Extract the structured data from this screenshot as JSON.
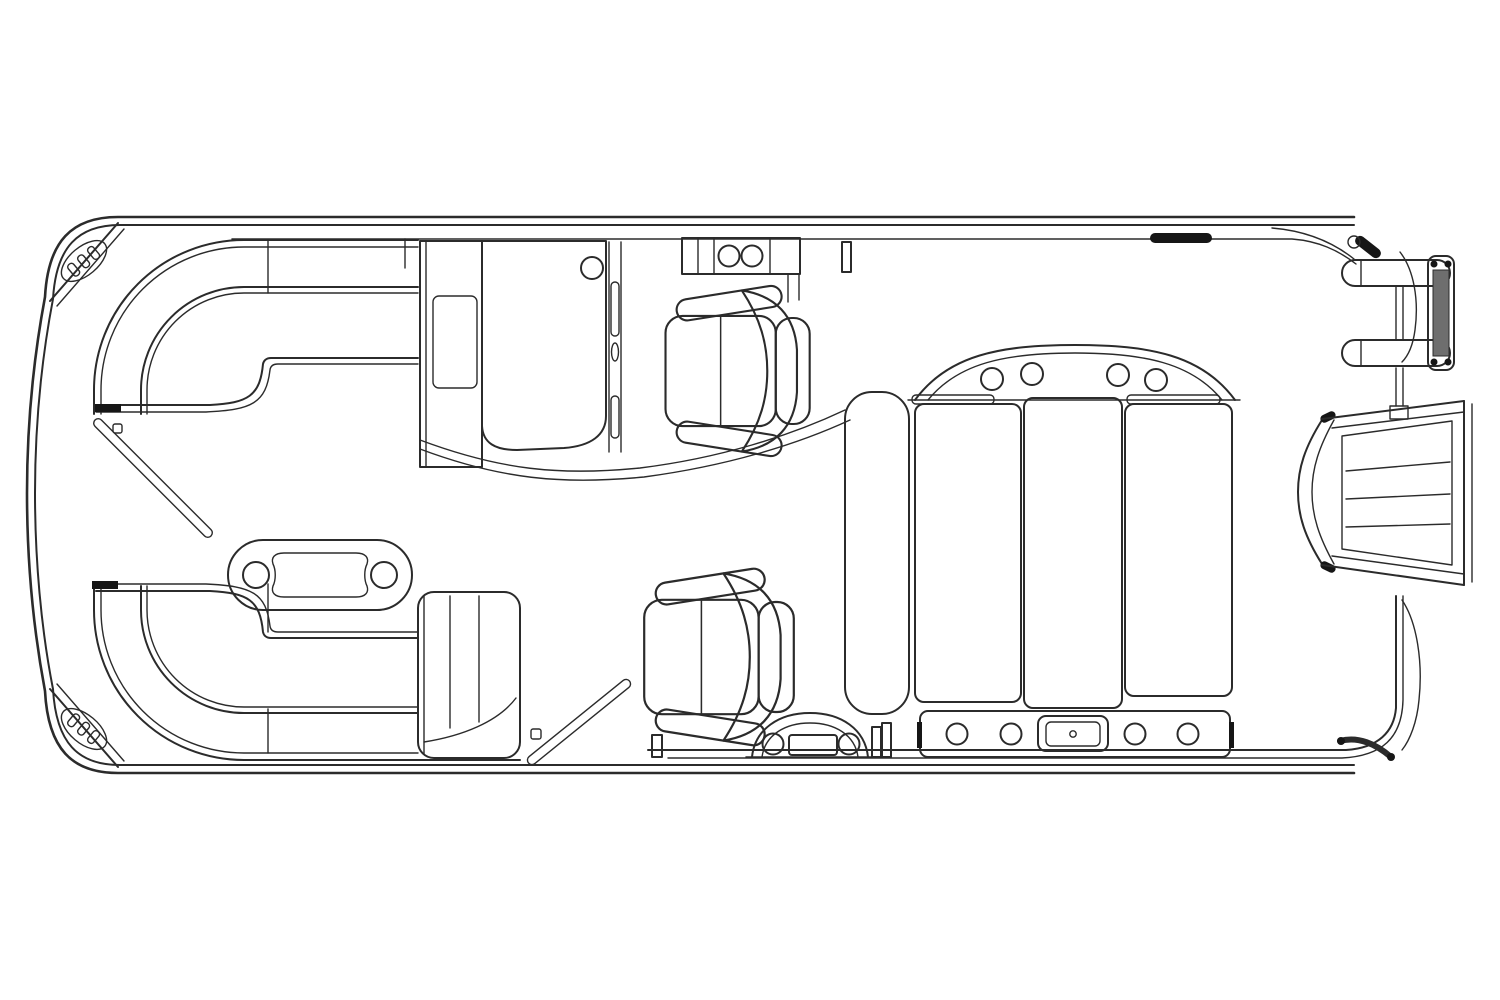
{
  "meta": {
    "title": "Pontoon boat deck floor plan (top view line drawing)",
    "type": "technical-floorplan",
    "orientation": "bow-left-stern-right"
  },
  "theme": {
    "background": "#ffffff",
    "line": "#2b2b2b",
    "dark": "#161616",
    "shade": "#6e6e6e"
  },
  "components": {
    "hull": "Pontoon deck outline with rub rail",
    "bow_speaker_caps": "Bow corner caps with speaker grilles",
    "bow_gate": "Bow boarding gate shown swung open",
    "side_gate": "Port side gate shown swung open",
    "port_bow_lounge": "Curved bow lounge seat, port side",
    "starboard_bow_lounge": "Curved L-shaped bow lounge seat with return backrest",
    "cocktail_table": "Oval cocktail table with two cup holders",
    "helm_console": "Helm console with steering wheel and storage cabinet",
    "windscreen": "Helm windscreen strip",
    "captain_chair_forward": "Forward captain's chair facing stern",
    "captain_chair_aft": "Second captain's chair facing stern",
    "cup_holder_console": "Top-side console with two cup holders",
    "rear_lounge": "Aft sun lounge with arched backrest, four cup holders and three cushions",
    "rear_step_panel": "Aft step panel with four cup holders and latch",
    "stern_step_pad": "Stern access pad with two round fittings",
    "boarding_ladder": "Folded stern boarding ladder",
    "outboard_motor": "Outboard motor cowling",
    "stern_rail": "Stern rail and fittings"
  }
}
